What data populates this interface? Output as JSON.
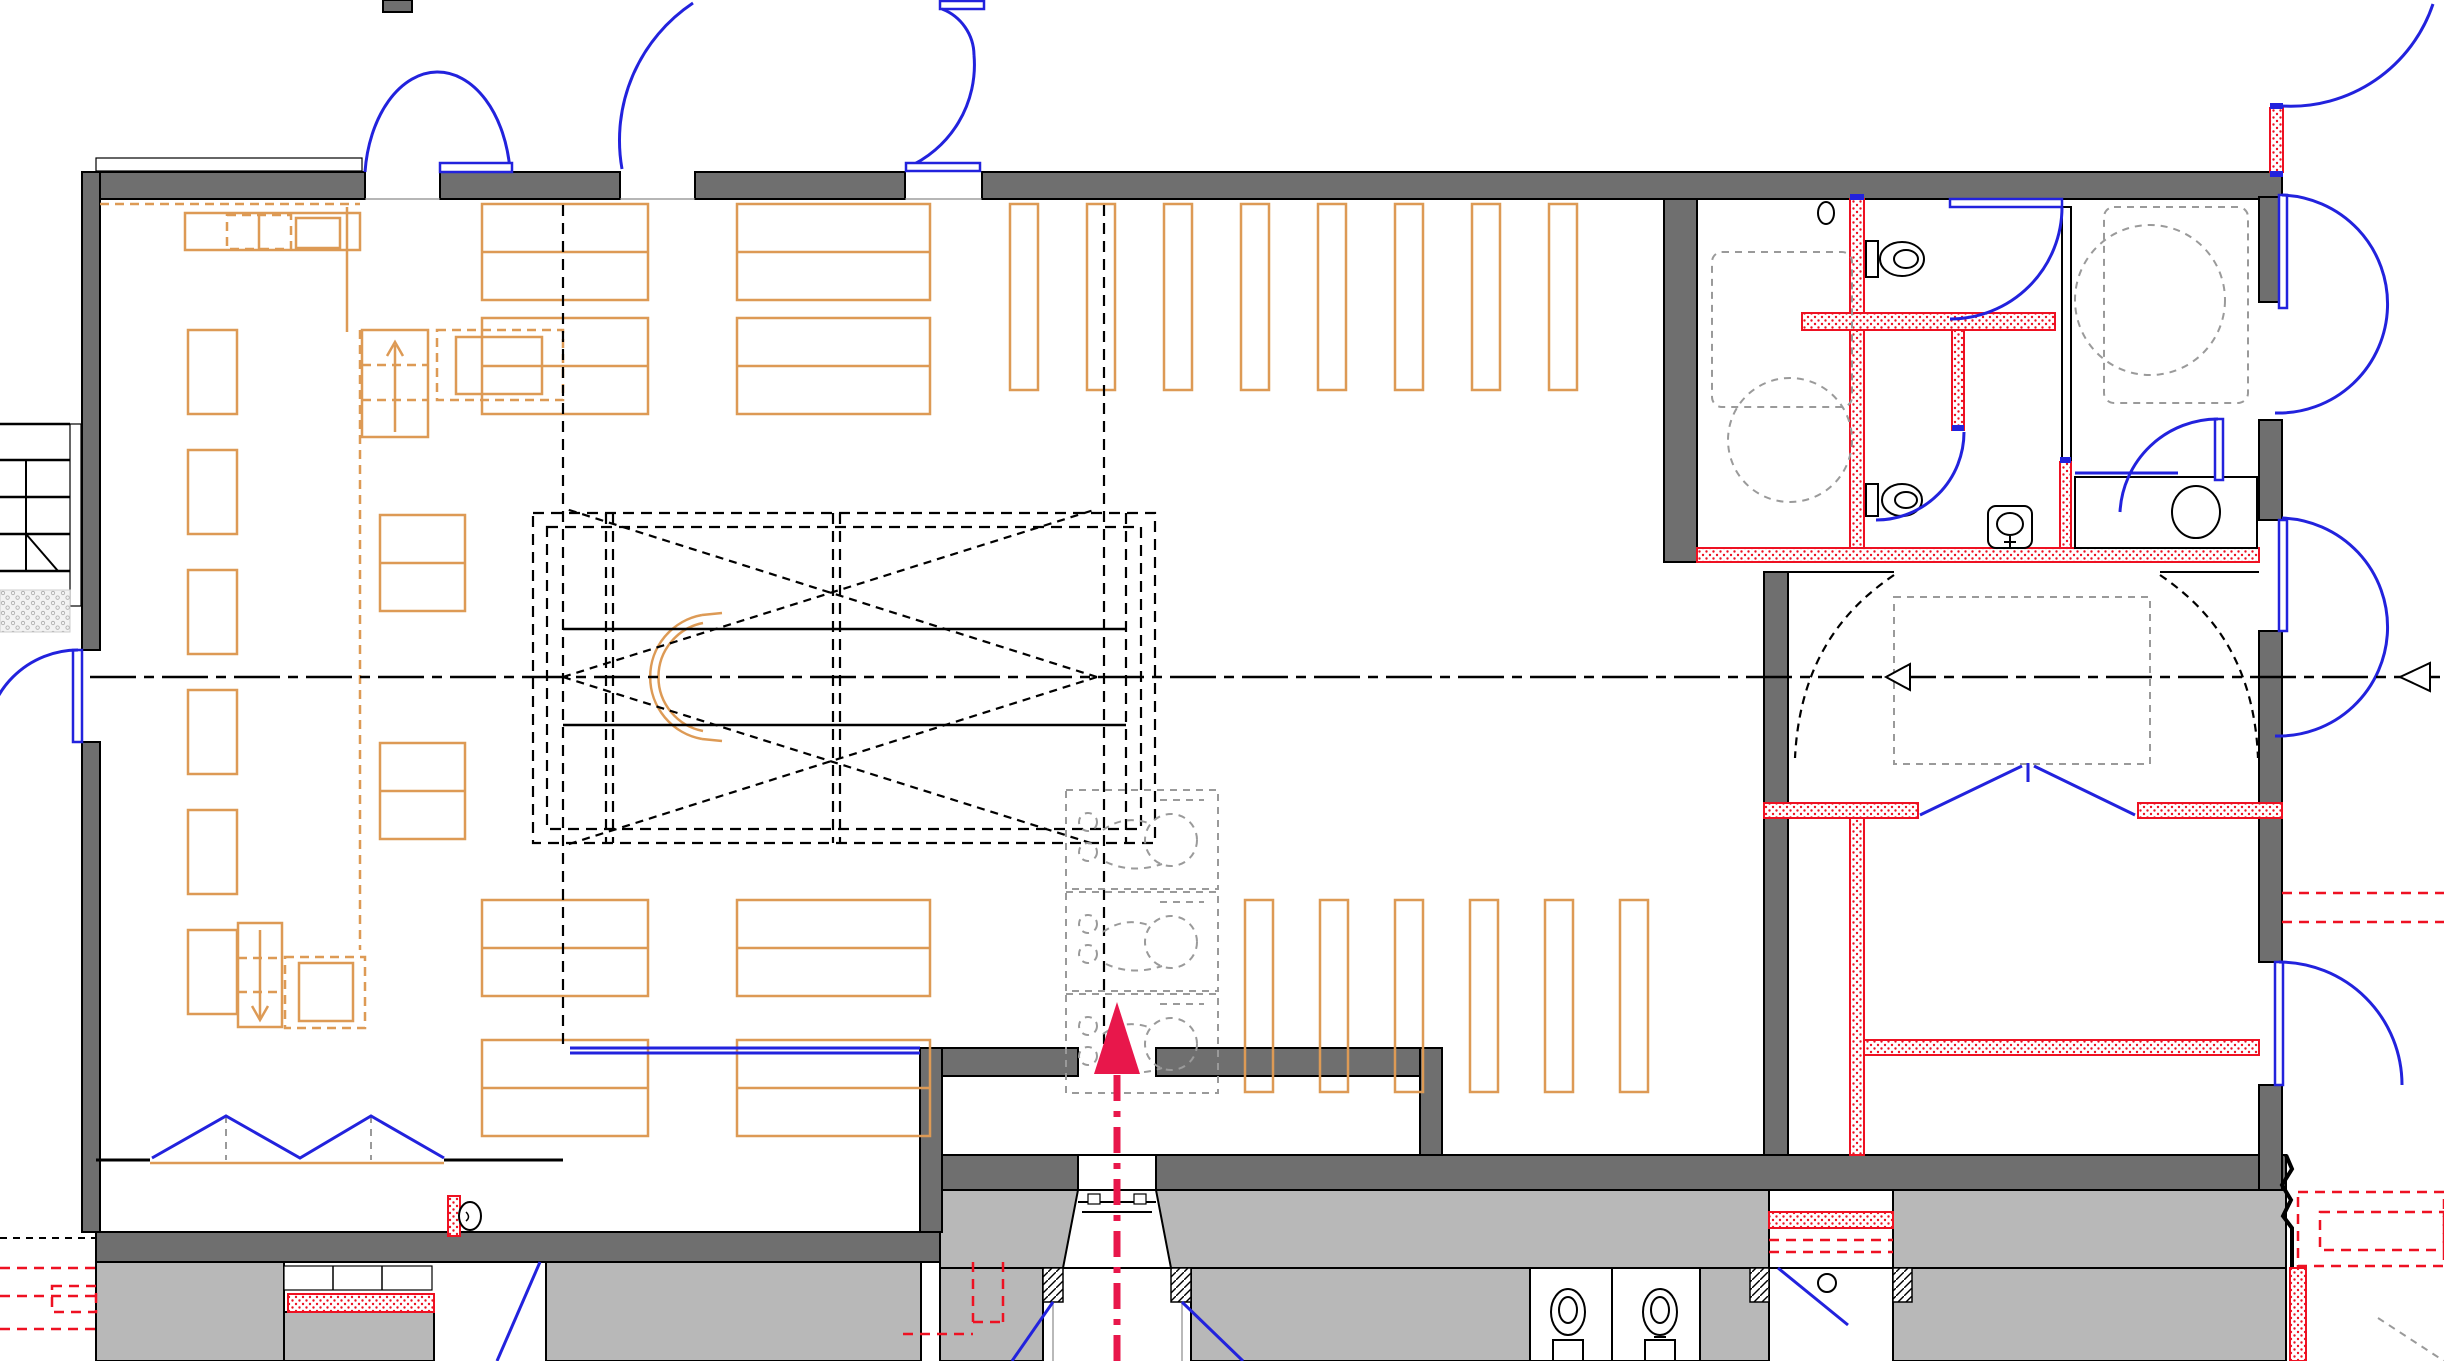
{
  "drawing": {
    "type": "architectural-floor-plan",
    "description": "church sanctuary renovation plan, no text labels visible",
    "colors": {
      "wall_dark": "#6f6f6f",
      "wall_light": "#b8b8b8",
      "door_blue": "#2222dd",
      "furniture_orange": "#dd9a55",
      "new_wall_red": "#ee1122",
      "entry_arrow_red": "#e8174b",
      "clearance_gray": "#9a9a9a",
      "background": "#ffffff"
    },
    "inventory": {
      "pew_row_blocks": 10,
      "pew_vertical_slats_upper": 8,
      "pew_vertical_slats_lower": 6,
      "toilets": 5,
      "lavatories": 2,
      "sinks": 1,
      "drinking_fountains": 1,
      "door_swing_arcs": 14,
      "folding_partition_leaves": 4,
      "musician_station_placeholders": 3,
      "clearance_circles": 3,
      "centerline_arrow_markers": 2,
      "entry_arrows": 1,
      "exterior_stairs": 1
    }
  }
}
